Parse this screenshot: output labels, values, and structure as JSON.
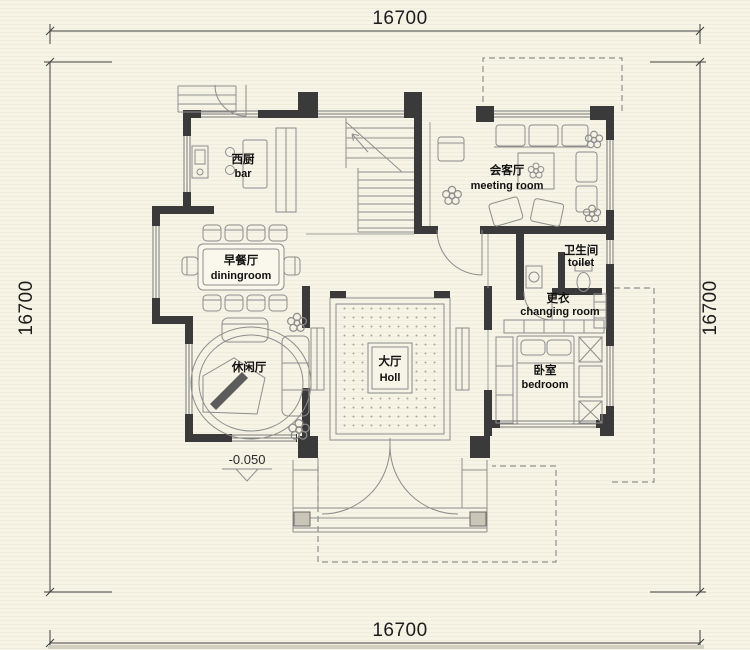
{
  "drawing": {
    "dimensions": {
      "top": "16700",
      "bottom": "16700",
      "left": "16700",
      "right": "16700"
    },
    "level_marker": "-0.050",
    "rooms": {
      "bar": {
        "label_zh": "西厨",
        "label_en": "bar"
      },
      "dining": {
        "label_zh": "早餐厅",
        "label_en": "diningroom"
      },
      "meeting": {
        "label_zh": "会客厅",
        "label_en": "meeting room"
      },
      "toilet": {
        "label_zh": "卫生间",
        "label_en": "toilet"
      },
      "changing": {
        "label_zh": "更衣",
        "label_en": "changing room"
      },
      "bedroom": {
        "label_zh": "卧室",
        "label_en": "bedroom"
      },
      "hall": {
        "label_zh": "大厅",
        "label_en": "Holl"
      },
      "leisure": {
        "label_zh": "休闲厅",
        "label_en": ""
      }
    },
    "colors": {
      "background": "#f6f4e6",
      "wall": "#3a3a3a",
      "line": "#8f8f8f",
      "dashed": "#8f8f8f",
      "text": "#1d1d1d"
    }
  }
}
